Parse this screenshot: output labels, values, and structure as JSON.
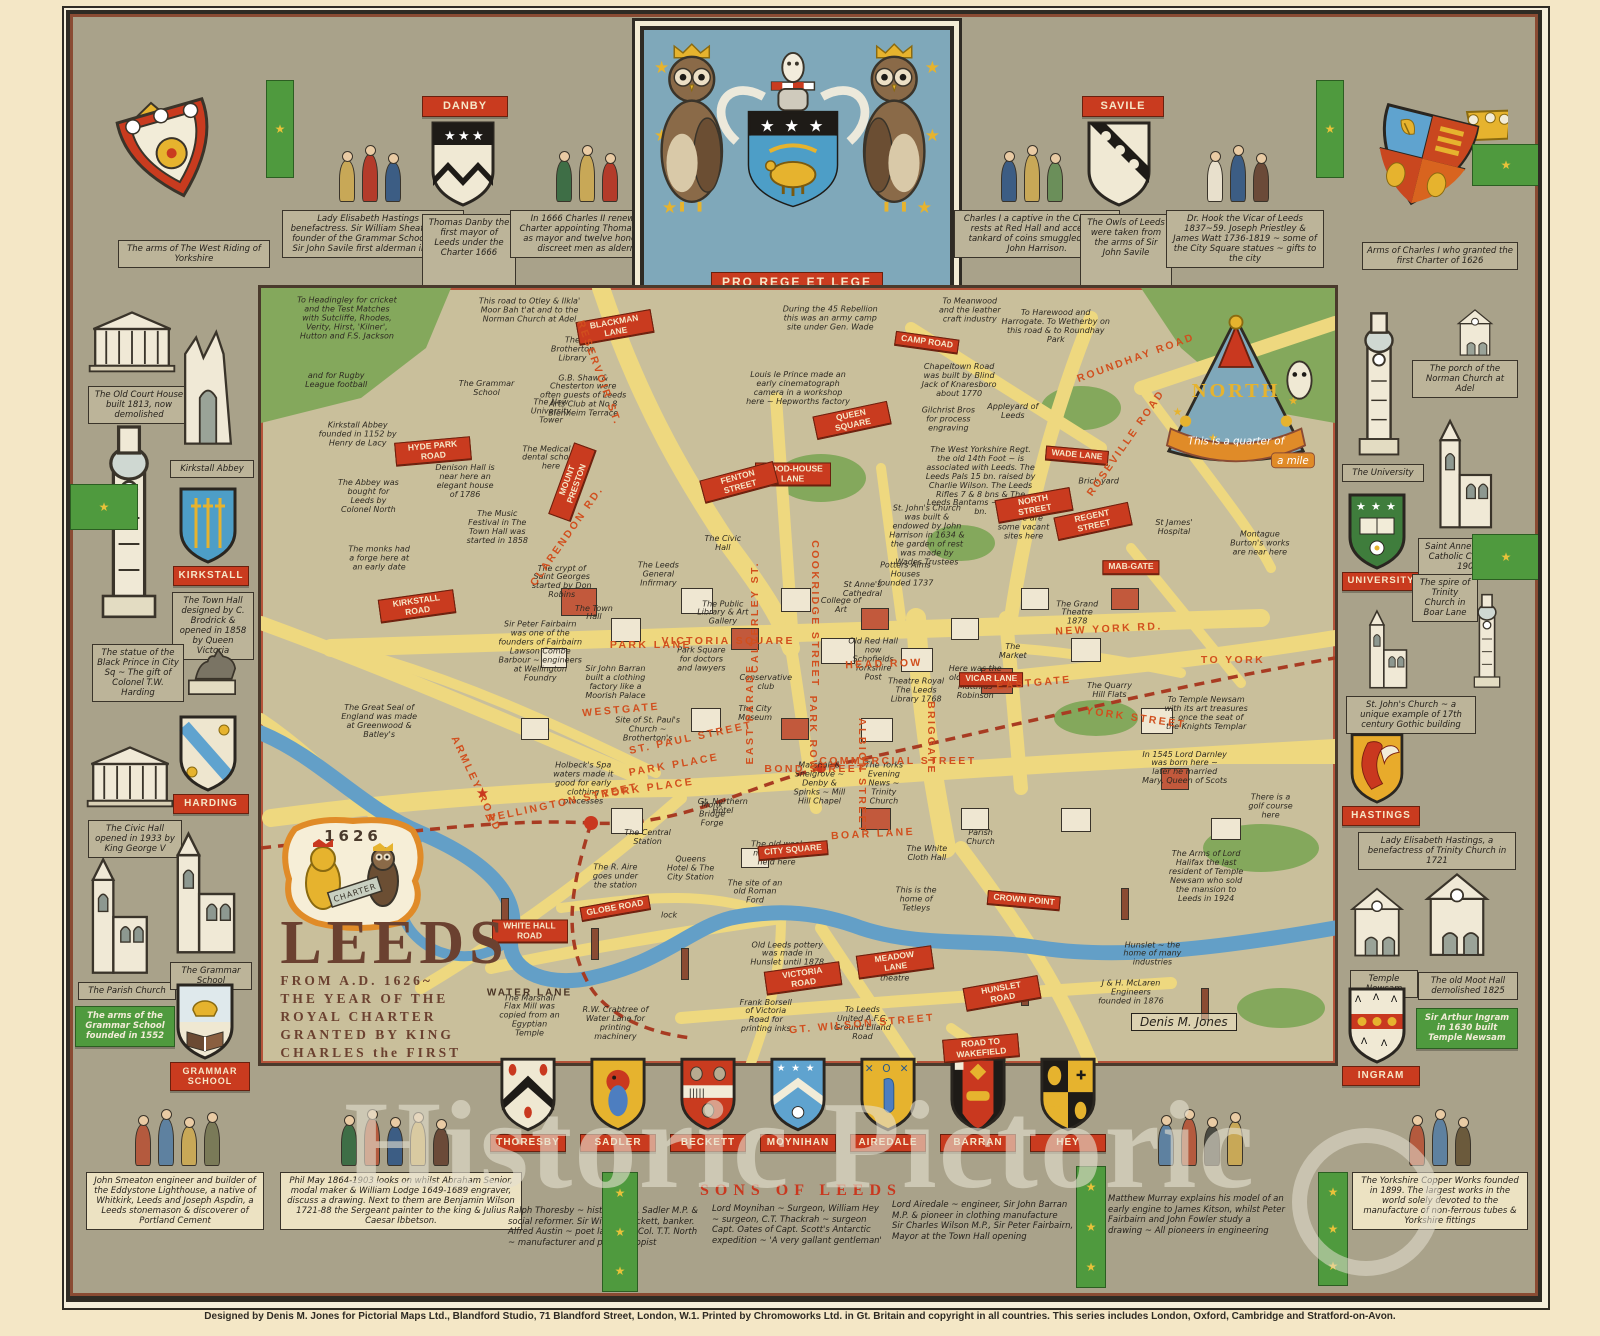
{
  "poster": {
    "watermark": "Historic Pictoric",
    "imprint": "Designed by Denis M. Jones for Pictorial Maps Ltd., Blandford Studio, 71 Blandford Street, London, W.1.  Printed by Chromoworks Ltd. in Gt. Britain and copyright in all countries.  This series includes London, Oxford, Cambridge and Stratford-on-Avon.",
    "signature": "Denis M. Jones"
  },
  "crest": {
    "motto": "PRO REGE ET LEGE"
  },
  "title": {
    "main": "LEEDS",
    "lines": [
      "FROM A.D. 1626~",
      "THE YEAR OF THE",
      "ROYAL CHARTER",
      "GRANTED BY KING",
      "CHARLES the FIRST"
    ],
    "charter_year": "1626",
    "charter_scroll": "CHARTER"
  },
  "compass": {
    "north": "NORTH",
    "scale1": "This is a quarter of",
    "scale2": "a mile"
  },
  "top_border": {
    "left_corner": "The arms of The West Riding of Yorkshire",
    "right_corner": "Arms of Charles I who granted the first Charter of 1626",
    "banners": {
      "danby": "DANBY",
      "savile": "SAVILE"
    },
    "captions": [
      "Lady Elisabeth Hastings ~ benefactress. Sir William Sheafield the founder of the Grammar School 1552. Sir John Savile first alderman in 1626.",
      "Thomas Danby the first mayor of Leeds under the Charter 1666",
      "In 1666 Charles II renews the Charter appointing Thomas Danby as mayor and twelve honest and discreet men as aldermen",
      "Charles I a captive in the Civil War rests at Red Hall and accepts a tankard of coins smuggled in by John Harrison.",
      "The Owls of Leeds were taken from the arms of Sir John Savile",
      "Dr. Hook the Vicar of Leeds 1837~59. Joseph Priestley & James Watt 1736-1819 ~ some of the City Square statues ~ gifts to the city"
    ]
  },
  "left_border": {
    "shields": [
      "KIRKSTALL",
      "HARDING",
      "GRAMMAR SCHOOL"
    ],
    "captions": [
      "The Old Court House built 1813, now demolished",
      "Kirkstall Abbey",
      "The Town Hall designed by C. Brodrick & opened in 1858 by Queen Victoria",
      "The statue of the Black Prince in City Sq ~ The gift of Colonel T.W. Harding",
      "The Civic Hall opened in 1933 by King George V",
      "The Parish Church",
      "The Grammar School",
      "The arms of the Grammar School founded in 1552"
    ]
  },
  "right_border": {
    "shields": [
      "UNIVERSITY",
      "HASTINGS",
      "INGRAM"
    ],
    "captions": [
      "The porch of the Norman Church at Adel",
      "The University",
      "Saint Anne's Roman Catholic Cathedral 1902",
      "The spire of Trinity Church in Boar Lane",
      "St. John's Church ~ a unique example of 17th century Gothic building",
      "Lady Elisabeth Hastings, a benefactress of Trinity Church in 1721",
      "Temple Newsam",
      "The old Moot Hall demolished 1825",
      "Sir Arthur Ingram in 1630 built Temple Newsam"
    ]
  },
  "bottom_border": {
    "shields": [
      "THORESBY",
      "SADLER",
      "BECKETT",
      "MOYNIHAN",
      "AIREDALE",
      "BARRAN",
      "HEY"
    ],
    "title": "SONS OF LEEDS",
    "corner_left": "John Smeaton engineer and builder of the Eddystone Lighthouse, a native of Whitkirk, Leeds and Joseph Aspdin, a Leeds stonemason & discoverer of Portland Cement",
    "scene_left": "Phil May 1864-1903 looks on whilst Abraham Senior, modal maker & William Lodge 1649-1689 engraver, discuss a drawing. Next to them are Benjamin Wilson 1721-88 the Sergeant painter to the king & Julius Caesar Ibbetson.",
    "columns": [
      "Ralph Thoresby ~ historian, M. Sadler M.P. & social reformer. Sir William Beckett, banker.\nAlfred Austin ~ poet laureate, Col. T.T. North ~ manufacturer and philanthropist",
      "Lord Moynihan ~ Surgeon, William Hey ~ surgeon, C.T. Thackrah ~ surgeon\nCapt. Oates of Capt. Scott's Antarctic expedition ~ 'A very gallant gentleman'",
      "Lord Airedale ~ engineer, Sir John Barran M.P. & pioneer in clothing manufacture\nSir Charles Wilson M.P., Sir Peter Fairbairn, Mayor at the Town Hall opening",
      "Matthew Murray explains his model of an early engine to James Kitson, whilst Peter Fairbairn and John Fowler study a drawing ~ All pioneers in engineering"
    ],
    "corner_right": "The Yorkshire Copper Works founded in 1899. The largest works in the world solely devoted to the manufacture of non-ferrous tubes & Yorkshire fittings"
  },
  "map": {
    "streets": [
      {
        "t": "BLACKMAN LANE",
        "x": 33,
        "y": 5,
        "r": -10,
        "k": "b"
      },
      {
        "t": "CAMP ROAD",
        "x": 62,
        "y": 7,
        "r": 8,
        "k": "b"
      },
      {
        "t": "QUEEN SQUARE",
        "x": 55,
        "y": 17,
        "r": -12,
        "k": "b"
      },
      {
        "t": "WOOD-HOUSE LANE",
        "x": 49.5,
        "y": 24,
        "r": 0,
        "k": "b"
      },
      {
        "t": "FENTON STREET",
        "x": 44.5,
        "y": 25,
        "r": -15,
        "k": "b"
      },
      {
        "t": "HYDE PARK ROAD",
        "x": 16,
        "y": 21,
        "r": -5,
        "k": "b"
      },
      {
        "t": "MOUNT PRESTON",
        "x": 29,
        "y": 25,
        "r": -70,
        "k": "b"
      },
      {
        "t": "RESERVOIR ST.",
        "x": 31.5,
        "y": 11,
        "r": 70,
        "k": "t"
      },
      {
        "t": "CLARENDON RD.",
        "x": 28.5,
        "y": 32,
        "r": -55,
        "k": "t"
      },
      {
        "t": "KIRKSTALL ROAD",
        "x": 14.5,
        "y": 41,
        "r": -8,
        "k": "b"
      },
      {
        "t": "REGENT STREET",
        "x": 77.5,
        "y": 30,
        "r": -12,
        "k": "b"
      },
      {
        "t": "NORTH STREET",
        "x": 72,
        "y": 28,
        "r": -10,
        "k": "b"
      },
      {
        "t": "WADE LANE",
        "x": 76,
        "y": 21.5,
        "r": 5,
        "k": "b"
      },
      {
        "t": "MAB-GATE",
        "x": 81,
        "y": 36,
        "r": 0,
        "k": "b"
      },
      {
        "t": "VICAR LANE",
        "x": 68,
        "y": 50.5,
        "r": 0,
        "k": "b"
      },
      {
        "t": "CITY SQUARE",
        "x": 49.5,
        "y": 72.5,
        "r": -5,
        "k": "b"
      },
      {
        "t": "WHITE HALL ROAD",
        "x": 25,
        "y": 83,
        "r": 0,
        "k": "b"
      },
      {
        "t": "GLOBE ROAD",
        "x": 33,
        "y": 80,
        "r": -10,
        "k": "b"
      },
      {
        "t": "VICTORIA ROAD",
        "x": 50.5,
        "y": 89,
        "r": -8,
        "k": "b"
      },
      {
        "t": "MEADOW LANE",
        "x": 59,
        "y": 87,
        "r": -8,
        "k": "b"
      },
      {
        "t": "HUNSLET ROAD",
        "x": 69,
        "y": 91,
        "r": -10,
        "k": "b"
      },
      {
        "t": "ROAD TO WAKEFIELD",
        "x": 67,
        "y": 98,
        "r": -5,
        "k": "b"
      },
      {
        "t": "CROWN POINT",
        "x": 71,
        "y": 79,
        "r": 5,
        "k": "b"
      },
      {
        "t": "NEW YORK RD.",
        "x": 79,
        "y": 44,
        "r": -3,
        "k": "t"
      },
      {
        "t": "TO YORK",
        "x": 90.5,
        "y": 48,
        "r": 0,
        "k": "t"
      },
      {
        "t": "YORK STREET",
        "x": 81.5,
        "y": 55.5,
        "r": 8,
        "k": "t"
      },
      {
        "t": "EASTGATE",
        "x": 72,
        "y": 51,
        "r": -5,
        "k": "t"
      },
      {
        "t": "HEAD  ROW",
        "x": 58,
        "y": 48.5,
        "r": -2,
        "k": "t"
      },
      {
        "t": "PARK ROW",
        "x": 51.4,
        "y": 57.5,
        "r": 90,
        "k": "t"
      },
      {
        "t": "EAST PARADE",
        "x": 45.5,
        "y": 55,
        "r": -90,
        "k": "t"
      },
      {
        "t": "COOKRIDGE STREET",
        "x": 51.6,
        "y": 42,
        "r": 90,
        "k": "t"
      },
      {
        "t": "CALVERLEY ST.",
        "x": 46,
        "y": 42.5,
        "r": -90,
        "k": "t"
      },
      {
        "t": "VICTORIA SQUARE",
        "x": 43.5,
        "y": 45.5,
        "r": 0,
        "k": "t"
      },
      {
        "t": "PARK LANE",
        "x": 36.3,
        "y": 46,
        "r": 0,
        "k": "t"
      },
      {
        "t": "ST. PAUL STREET",
        "x": 40,
        "y": 58,
        "r": -12,
        "k": "t"
      },
      {
        "t": "PARK PLACE",
        "x": 38.5,
        "y": 61.5,
        "r": -10,
        "k": "t"
      },
      {
        "t": "YORK PLACE",
        "x": 36,
        "y": 64.5,
        "r": -8,
        "k": "t"
      },
      {
        "t": "WESTGATE",
        "x": 33.5,
        "y": 54.5,
        "r": -5,
        "k": "t"
      },
      {
        "t": "WELLINGTON STREET",
        "x": 28,
        "y": 66.5,
        "r": -12,
        "k": "t"
      },
      {
        "t": "ARMLEY ROAD",
        "x": 20,
        "y": 64,
        "r": 65,
        "k": "t"
      },
      {
        "t": "BOAR LANE",
        "x": 57,
        "y": 70.5,
        "r": -3,
        "k": "t"
      },
      {
        "t": "BRIGGATE",
        "x": 62.4,
        "y": 58,
        "r": 90,
        "k": "t"
      },
      {
        "t": "ALBION STREET",
        "x": 56,
        "y": 63,
        "r": 90,
        "k": "t"
      },
      {
        "t": "BOND STREET",
        "x": 51.6,
        "y": 62,
        "r": 0,
        "k": "t"
      },
      {
        "t": "COMMERCIAL STREET",
        "x": 59.3,
        "y": 61,
        "r": 0,
        "k": "t"
      },
      {
        "t": "GT. WILSON STREET",
        "x": 56,
        "y": 95,
        "r": -5,
        "k": "t"
      },
      {
        "t": "WATER LANE",
        "x": 25,
        "y": 91,
        "r": 0,
        "k": "d"
      },
      {
        "t": "ROUNDHAY ROAD",
        "x": 81.5,
        "y": 9,
        "r": -20,
        "k": "t"
      },
      {
        "t": "ROSEVILLE ROAD",
        "x": 80.5,
        "y": 20,
        "r": -55,
        "k": "t"
      }
    ],
    "notes": [
      {
        "t": "To Headingley for cricket and the Test Matches with Sutcliffe, Rhodes, Verity, Hirst, 'Kilner', Hutton and F.S. Jackson",
        "x": 8,
        "y": 4,
        "w": 104
      },
      {
        "t": "and for Rugby League football",
        "x": 7,
        "y": 12,
        "w": 70
      },
      {
        "t": "Kirkstall Abbey founded in 1152 by Henry de Lacy",
        "x": 9,
        "y": 19,
        "w": 80
      },
      {
        "t": "This road to Otley & Ilkla' Moor Bah t'at and to the Norman Church at Adel",
        "x": 25,
        "y": 3,
        "w": 112
      },
      {
        "t": "G.B. Shaw & Chesterton were often guests of Leeds Arts Club at No 8 Blenheim Terrace",
        "x": 30,
        "y": 14,
        "w": 88
      },
      {
        "t": "During the 45 Rebellion this was an army camp site under Gen. Wade",
        "x": 53,
        "y": 4,
        "w": 102
      },
      {
        "t": "Louis le Prince made an early cinematograph camera in a workshop here ~ Hepworths factory",
        "x": 50,
        "y": 13,
        "w": 104
      },
      {
        "t": "To Meanwood and the leather craft industry",
        "x": 66,
        "y": 3,
        "w": 70
      },
      {
        "t": "To Harewood and Harrogate. To Wetherby on this road & to Roundhay Park",
        "x": 74,
        "y": 5,
        "w": 112
      },
      {
        "t": "Chapeltown Road was built by Blind Jack of Knaresboro about 1770",
        "x": 65,
        "y": 12,
        "w": 82
      },
      {
        "t": "Appleyard of Leeds",
        "x": 70,
        "y": 16,
        "w": 56
      },
      {
        "t": "St James' Hospital",
        "x": 85,
        "y": 31,
        "w": 56
      },
      {
        "t": "Montague Burton's works are near here",
        "x": 93,
        "y": 33,
        "w": 68
      },
      {
        "t": "Brick yard",
        "x": 78,
        "y": 25,
        "w": 46
      },
      {
        "t": "The Brotherton Library",
        "x": 29,
        "y": 8,
        "w": 60
      },
      {
        "t": "The New University Tower",
        "x": 27,
        "y": 16,
        "w": 60
      },
      {
        "t": "The Medical & dental schools here",
        "x": 27,
        "y": 22,
        "w": 64
      },
      {
        "t": "The Grammar School",
        "x": 21,
        "y": 13,
        "w": 56
      },
      {
        "t": "Denison Hall is near here an elegant house of 1786",
        "x": 19,
        "y": 25,
        "w": 66
      },
      {
        "t": "The Music Festival in The Town Hall was started in 1858",
        "x": 22,
        "y": 31,
        "w": 70
      },
      {
        "t": "The Abbey was bought for Leeds by Colonel North",
        "x": 10,
        "y": 27,
        "w": 64
      },
      {
        "t": "The monks had a forge here at an early date",
        "x": 11,
        "y": 35,
        "w": 64
      },
      {
        "t": "The crypt of Saint Georges started by Don Robins",
        "x": 28,
        "y": 38,
        "w": 62
      },
      {
        "t": "The Civic Hall",
        "x": 43,
        "y": 33,
        "w": 46
      },
      {
        "t": "The Leeds General Infirmary",
        "x": 37,
        "y": 37,
        "w": 52
      },
      {
        "t": "The Public Library & Art Gallery",
        "x": 43,
        "y": 42,
        "w": 62
      },
      {
        "t": "Potters Alms Houses founded 1737",
        "x": 60,
        "y": 37,
        "w": 58
      },
      {
        "t": "College of Art",
        "x": 54,
        "y": 41,
        "w": 44
      },
      {
        "t": "Gilchrist Bros for process engraving",
        "x": 64,
        "y": 17,
        "w": 56
      },
      {
        "t": "The West Yorkshire Regt. the old 14th Foot ~ is associated with Leeds. The Leeds Pals 15 bn. raised by Charlie Wilson. The Leeds Rifles 7 & 8 bns & The Leeds Bantams ~ the 17th bn.",
        "x": 67,
        "y": 25,
        "w": 112
      },
      {
        "t": "St. John's Church was built & endowed by John Harrison in 1634 & the garden of rest was made by Wades Trustees",
        "x": 62,
        "y": 32,
        "w": 82
      },
      {
        "t": "There are some vacant sites here",
        "x": 71,
        "y": 31,
        "w": 54
      },
      {
        "t": "The Quarry Hill Flats",
        "x": 79,
        "y": 52,
        "w": 58
      },
      {
        "t": "St Anne's Cathedral",
        "x": 56,
        "y": 39,
        "w": 56
      },
      {
        "t": "The Town Hall",
        "x": 31,
        "y": 42,
        "w": 46
      },
      {
        "t": "Park Square for doctors and lawyers",
        "x": 41,
        "y": 48,
        "w": 54
      },
      {
        "t": "Conservative club",
        "x": 47,
        "y": 51,
        "w": 54
      },
      {
        "t": "The City Museum",
        "x": 46,
        "y": 55,
        "w": 44
      },
      {
        "t": "Old Red Hall now Schofields Yorkshire Post",
        "x": 57,
        "y": 48,
        "w": 56
      },
      {
        "t": "Theatre Royal The Leeds Library 1768",
        "x": 61,
        "y": 52,
        "w": 58
      },
      {
        "t": "Here was the old Moot Hall Matthias Robinson",
        "x": 66.5,
        "y": 51,
        "w": 54
      },
      {
        "t": "The Grand Theatre 1878",
        "x": 76,
        "y": 42,
        "w": 54
      },
      {
        "t": "The Market",
        "x": 70,
        "y": 47,
        "w": 44
      },
      {
        "t": "Sir John Barran built a clothing factory like a Moorish Palace",
        "x": 33,
        "y": 51,
        "w": 62
      },
      {
        "t": "Site of St. Paul's Church ~ Brotherton's",
        "x": 36,
        "y": 57,
        "w": 70
      },
      {
        "t": "Sir Peter Fairbairn was one of the founders of Fairbairn Lawson Combe Barbour ~ engineers at Wellington Foundry",
        "x": 26,
        "y": 47,
        "w": 84
      },
      {
        "t": "The Great Seal of England was made at Greenwood & Batley's",
        "x": 11,
        "y": 56,
        "w": 78
      },
      {
        "t": "Holbeck's Spa waters made it good for early clothing processes",
        "x": 30,
        "y": 64,
        "w": 74
      },
      {
        "t": "Monk Bridge Forge",
        "x": 42,
        "y": 68,
        "w": 46
      },
      {
        "t": "The Central Station",
        "x": 36,
        "y": 71,
        "w": 50
      },
      {
        "t": "Gt. Northern Hotel",
        "x": 43,
        "y": 67,
        "w": 56
      },
      {
        "t": "Queens Hotel & The City Station",
        "x": 40,
        "y": 75,
        "w": 54
      },
      {
        "t": "The R. Aire goes under the station",
        "x": 33,
        "y": 76,
        "w": 60
      },
      {
        "t": "lock",
        "x": 38,
        "y": 81,
        "w": 30
      },
      {
        "t": "The old wool market was held here",
        "x": 48,
        "y": 73,
        "w": 60
      },
      {
        "t": "The site of an old Roman Ford",
        "x": 46,
        "y": 78,
        "w": 56
      },
      {
        "t": "The White Cloth Hall",
        "x": 62,
        "y": 73,
        "w": 52
      },
      {
        "t": "Parish Church",
        "x": 67,
        "y": 71,
        "w": 44
      },
      {
        "t": "This is the home of Tetleys",
        "x": 61,
        "y": 79,
        "w": 50
      },
      {
        "t": "In 1545 Lord Darnley was born here ~ later he married Mary, Queen of Scots",
        "x": 86,
        "y": 62,
        "w": 86
      },
      {
        "t": "To Temple Newsam with its art treasures ~ once the seat of the Knights Templar",
        "x": 88,
        "y": 55,
        "w": 86
      },
      {
        "t": "There is a golf course here",
        "x": 94,
        "y": 67,
        "w": 50
      },
      {
        "t": "The Arms of Lord Halifax the last resident of Temple Newsam who sold the mansion to Leeds in 1924",
        "x": 88,
        "y": 76,
        "w": 82
      },
      {
        "t": "Hunslet ~ the home of many industries",
        "x": 83,
        "y": 86,
        "w": 62
      },
      {
        "t": "J & H. McLaren Engineers founded in 1876",
        "x": 81,
        "y": 91,
        "w": 72
      },
      {
        "t": "Old Leeds pottery was made in Hunslet until 1878",
        "x": 49,
        "y": 86,
        "w": 78
      },
      {
        "t": "Here stood Tate Wilkinson's theatre",
        "x": 59,
        "y": 88,
        "w": 64
      },
      {
        "t": "Frank Borsell of Victoria Road for printing inks",
        "x": 47,
        "y": 94,
        "w": 62
      },
      {
        "t": "To Leeds United A.F.C. Ground Elland Road",
        "x": 56,
        "y": 95,
        "w": 62
      },
      {
        "t": "R.W. Crabtree of Water Lane for printing machinery",
        "x": 33,
        "y": 95,
        "w": 74
      },
      {
        "t": "The Marshall Flax Mill was copied from an Egyptian Temple",
        "x": 25,
        "y": 94,
        "w": 66
      },
      {
        "t": "The Yorks Evening News ~ Trinity Church",
        "x": 58,
        "y": 64,
        "w": 54
      },
      {
        "t": "Marshall & Snelgrove ~ Denby & Spinks ~ Mill Hill Chapel",
        "x": 52,
        "y": 64,
        "w": 56
      }
    ]
  }
}
